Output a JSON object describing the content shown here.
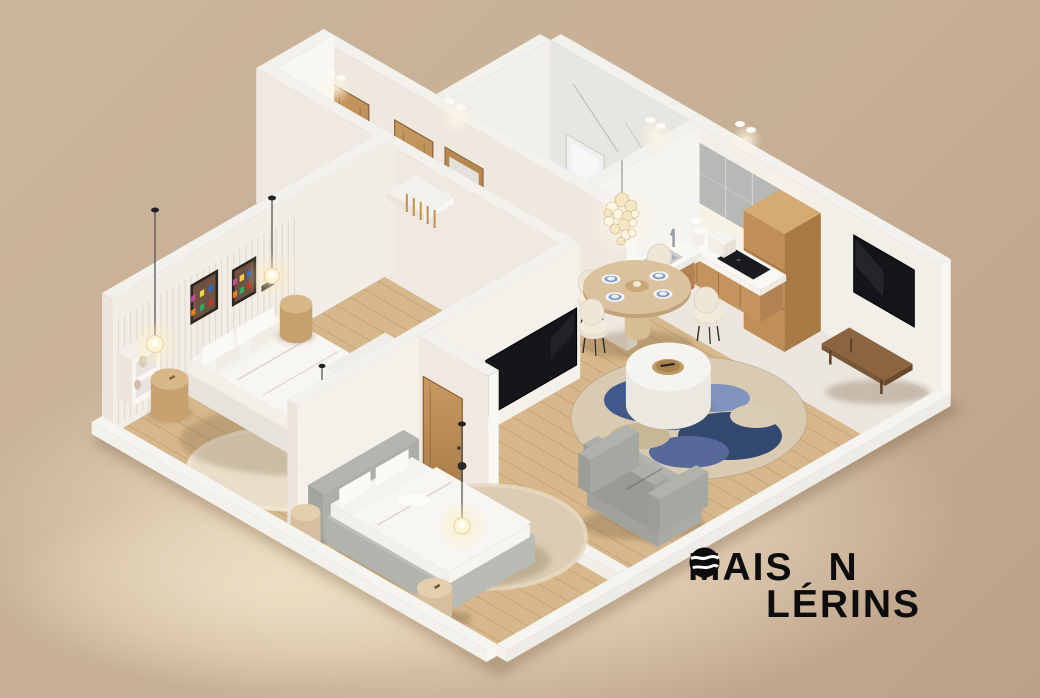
{
  "brand": {
    "line1_pre": "MAIS",
    "line1_post": "N",
    "line2": "LÉRINS",
    "full_name": "MAISON LÉRINS"
  },
  "palette": {
    "background": "#cbb59b",
    "background_deep": "#bda288",
    "floor_glow": "#f6e8cd",
    "wall_white": "#f3f1ec",
    "wall_shade": "#ebe5dc",
    "wall_bright": "#f9f7f3",
    "wood_floor": "#d7b88c",
    "hall_floor": "#e4d1ad",
    "oak_door": "#c0915a",
    "gray_cabinet": "#b7b9b6",
    "counter_white": "#f5f3ee",
    "marble": "#e8e6e2",
    "tv_black": "#141519",
    "sofa_gray": "#a6a8a2",
    "rug_blue": "#40598e",
    "rug_beige": "#dcccb2",
    "bench_walnut": "#7a5737",
    "logo_black": "#0d0d0d"
  }
}
